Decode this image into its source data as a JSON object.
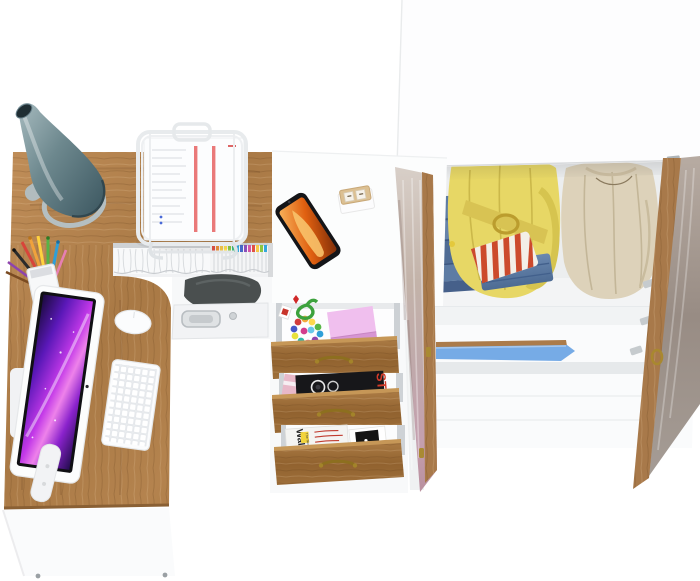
{
  "meta": {
    "description": "Top-down product render of a corner desk workstation with open drawers and an open wardrobe filled with clothes",
    "background": "#ffffff"
  },
  "palette": {
    "wood": "#b08049",
    "wood_edge": "#8a6234",
    "drawer_wood": "#9c6f3c",
    "panel_white": "#fbfcfd",
    "lamp_teal": "#5f7c84",
    "screen_magenta": "#c238e8",
    "shelf_blue": "#76abe6",
    "denim_blue": "#5d7ca4",
    "jacket_yellow": "#e7d765",
    "coat_beige": "#ddd2ba",
    "stripe_red": "#cc4a2c",
    "brass": "#8d6f1f",
    "pink_block": "#f0bfee"
  },
  "desk": {
    "items": [
      "desk-lamp",
      "document-stand",
      "pen-cup",
      "all-in-one-monitor",
      "keyboard",
      "mouse",
      "smartphone",
      "wooden-desk-calendar",
      "magazine-shelf",
      "storage-compartment"
    ]
  },
  "drawers": {
    "top": {
      "contents": [
        "pink note block",
        "bead necklace",
        "green cord",
        "red charm"
      ]
    },
    "middle": {
      "contents": [
        "black photo magazine"
      ],
      "cover_text": "ST"
    },
    "bottom": {
      "contents": [
        "white design magazine",
        "black logo magazine"
      ],
      "cover_text": "Wall",
      "cover_subtext": "The New",
      "logo_glyph": "♣"
    }
  },
  "wardrobe": {
    "clothes": [
      "folded jeans",
      "yellow belted jacket",
      "red striped shirt",
      "beige coat"
    ],
    "accents": {
      "shelf_edge": "blue",
      "handles": "antique gold",
      "hinges": "silver"
    }
  }
}
